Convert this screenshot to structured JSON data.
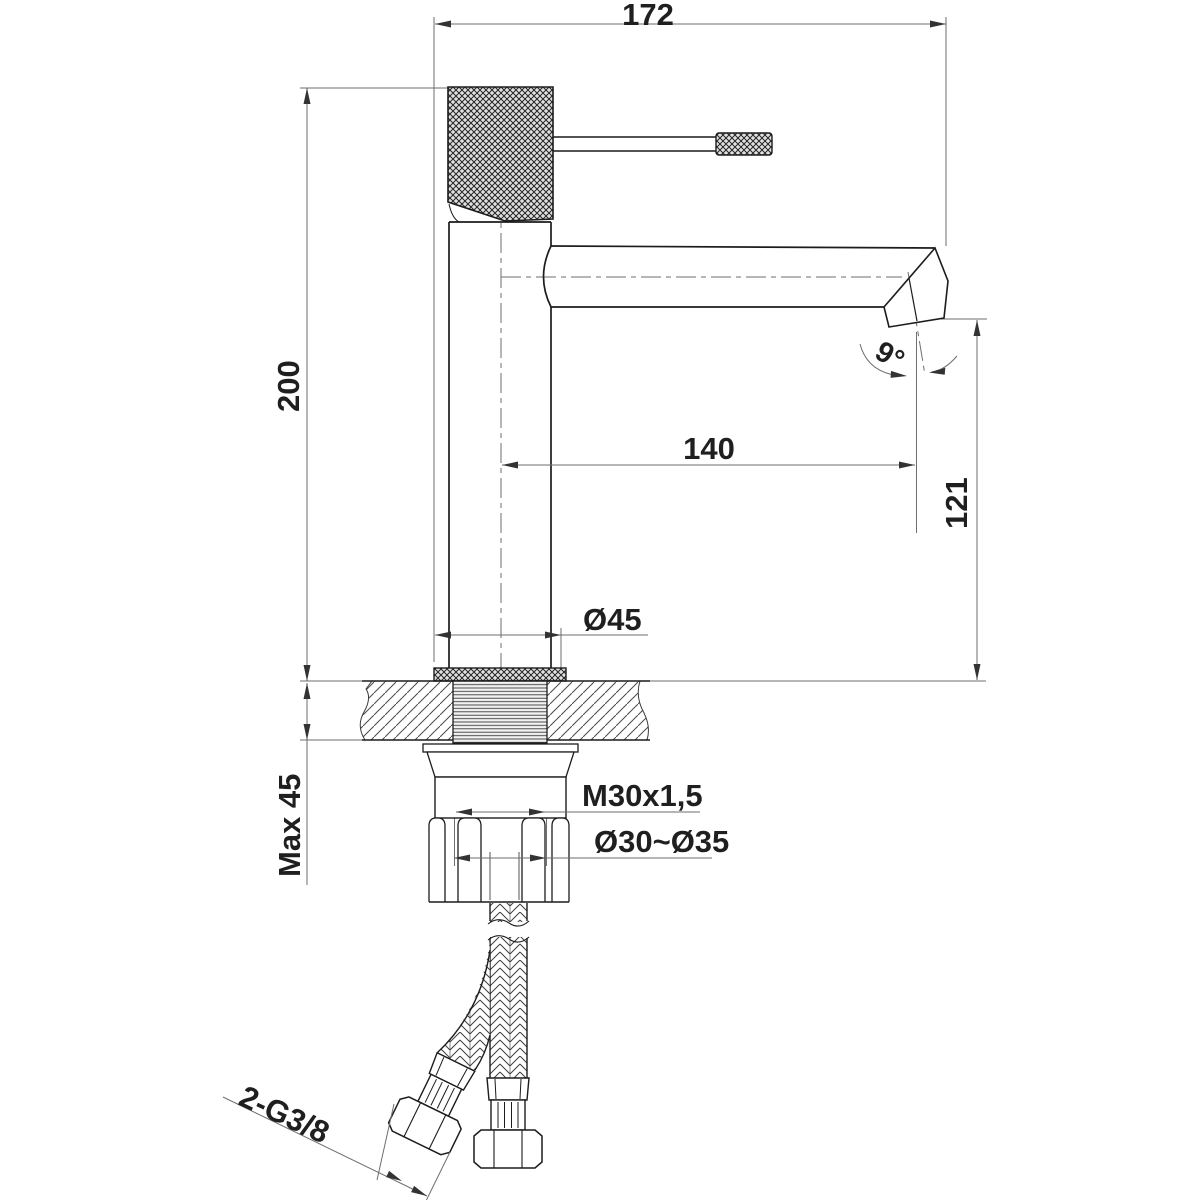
{
  "drawing": {
    "type": "single-lever basin faucet installation dimension drawing",
    "dimensions": {
      "total_width": "172",
      "total_height": "200",
      "spout_reach": "140",
      "spout_outlet_height": "121",
      "base_diameter": "Ø45",
      "max_counter_thickness": "Max 45",
      "mounting_thread": "M30x1,5",
      "mounting_hole_range": "Ø30~Ø35",
      "hose_connections": "2-G3/8",
      "spout_angle": "9°"
    },
    "colors": {
      "outline": "#1c1c1c",
      "dimension_line": "#6e6e6e",
      "text": "#1f1f1f",
      "background": "#ffffff"
    }
  }
}
